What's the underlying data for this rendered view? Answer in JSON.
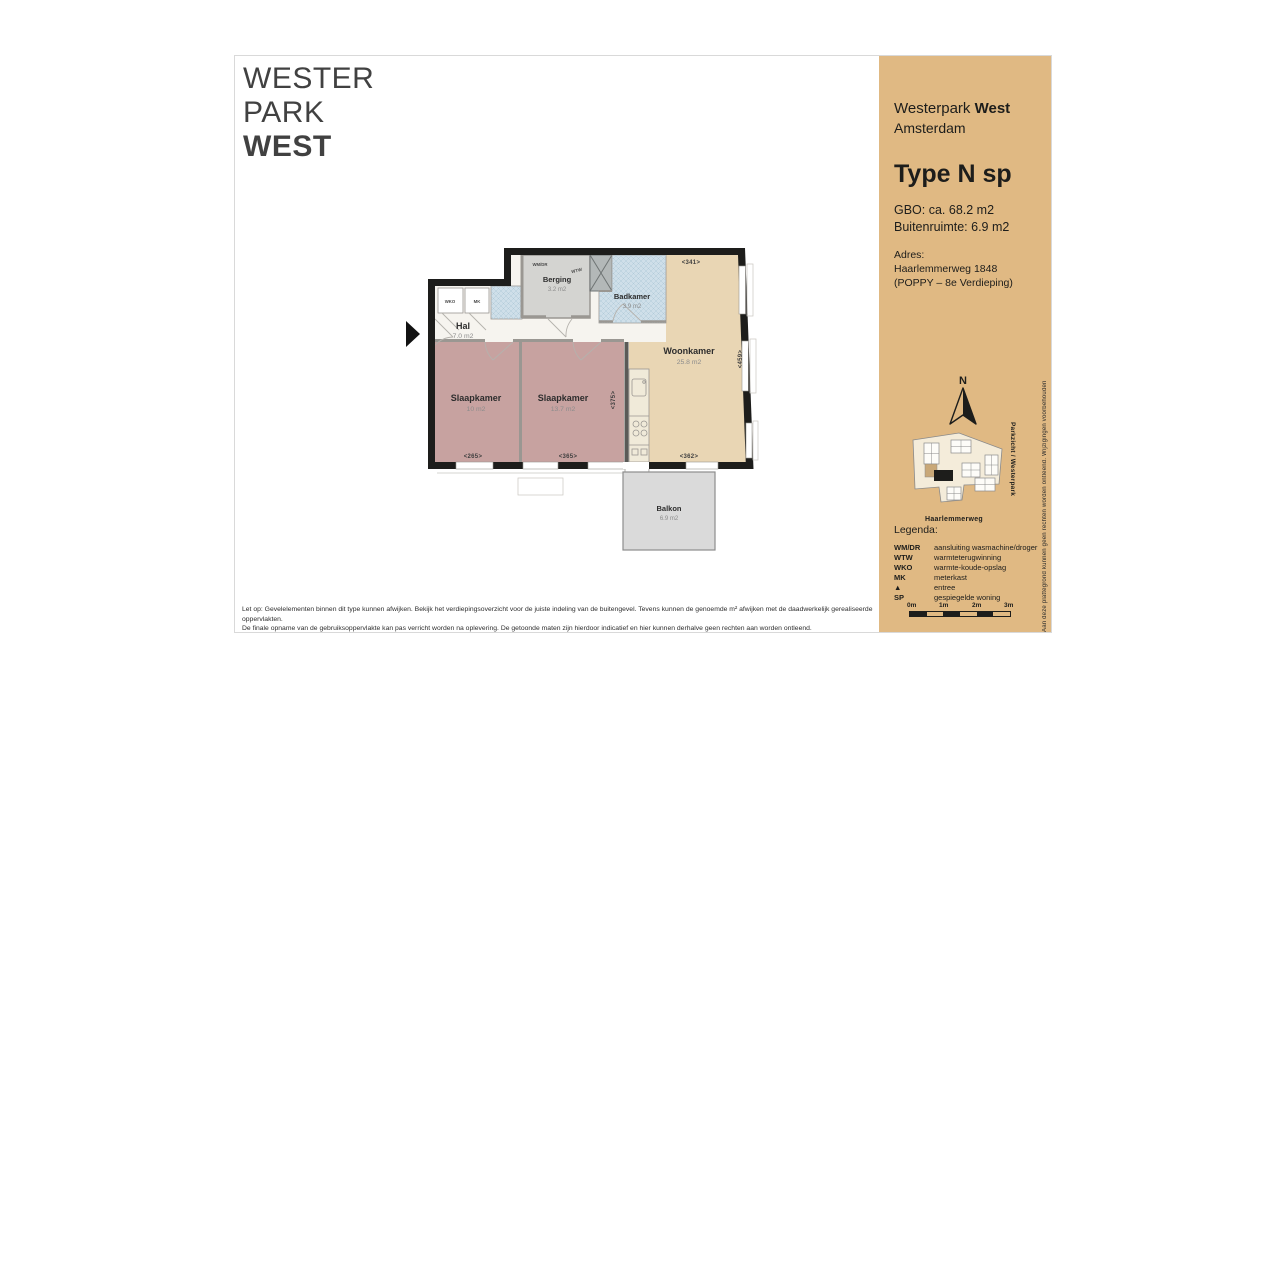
{
  "page": {
    "logo_lines": [
      "WESTER",
      "PARK",
      "WEST"
    ]
  },
  "sidebar": {
    "project": "Westerpark ",
    "project_bold": "West",
    "city": "Amsterdam",
    "type_title": "Type N sp",
    "gbo": "GBO: ca. 68.2 m2",
    "buitenruimte": "Buitenruimte: 6.9 m2",
    "adres_label": "Adres:",
    "adres_line1": "Haarlemmerweg 1848",
    "adres_line2": "(POPPY – 8e Verdieping)",
    "compass_letter": "N",
    "map_street": "Haarlemmerweg",
    "map_side_label": "Parkzicht / Westerpark",
    "edge_note": "Aan deze plattegrond kunnen geen rechten worden ontleend. Wijzigingen voorbehouden",
    "legend_title": "Legenda:",
    "legend": [
      {
        "abbr": "WM/DR",
        "desc": "aansluiting wasmachine/droger"
      },
      {
        "abbr": "WTW",
        "desc": "warmteterugwinning"
      },
      {
        "abbr": "WKO",
        "desc": "warmte-koude-opslag"
      },
      {
        "abbr": "MK",
        "desc": "meterkast"
      },
      {
        "abbr": "▲",
        "desc": "entree"
      },
      {
        "abbr": "SP",
        "desc": "gespiegelde woning"
      }
    ],
    "scale_labels": [
      "0m",
      "1m",
      "2m",
      "3m"
    ],
    "panel_color": "#e0b983"
  },
  "plan": {
    "rooms": [
      {
        "name": "Hal",
        "area": "7.0 m2"
      },
      {
        "name": "Berging",
        "area": "3.2 m2"
      },
      {
        "name": "Badkamer",
        "area": "3.9 m2"
      },
      {
        "name": "Woonkamer",
        "area": "25.8 m2"
      },
      {
        "name": "Slaapkamer",
        "area": "10 m2"
      },
      {
        "name": "Slaapkamer",
        "area": "13.7 m2"
      },
      {
        "name": "Balkon",
        "area": "6.9 m2"
      }
    ],
    "small_labels": {
      "wmdr": "WM/DR",
      "wtw": "WTW",
      "wko": "WKO",
      "mk": "MK"
    },
    "dims": {
      "top": "<341>",
      "right": "<459>",
      "bottom": "<362>",
      "bed1": "<265>",
      "bed2": "<365>",
      "mid": "<375>"
    },
    "colors": {
      "wall": "#1d1d1b",
      "bedroom": "#c7a2a0",
      "living": "#e9d6b4",
      "hall": "#f6f4ef",
      "storage": "#d4d4d1",
      "wet": "#cfdfe9",
      "balcony": "#dadada"
    }
  },
  "footer": {
    "line1": "Let op: Gevelelementen binnen dit type kunnen afwijken. Bekijk het verdiepingsoverzicht voor de juiste indeling van de buitengevel. Tevens kunnen de genoemde m² afwijken met de daadwerkelijk gerealiseerde oppervlakten.",
    "line2": "De finale opname van de gebruiksoppervlakte kan pas verricht worden na oplevering. De getoonde maten zijn hierdoor indicatief en hier kunnen derhalve geen rechten aan worden ontleend."
  }
}
